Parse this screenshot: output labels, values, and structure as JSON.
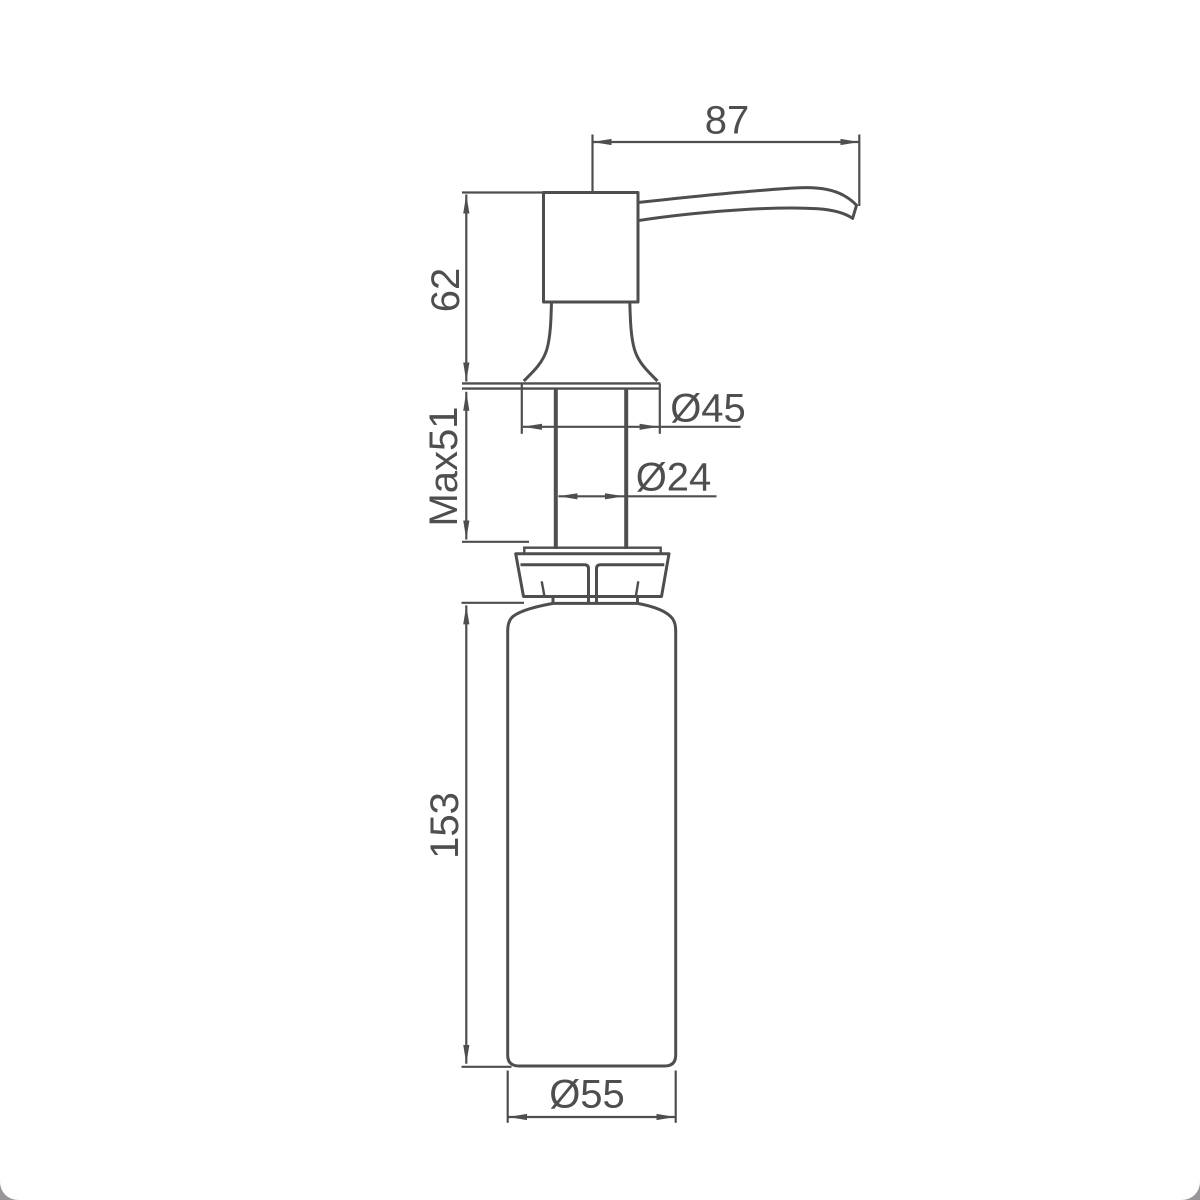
{
  "page": {
    "background": "#ffffff",
    "corner_mask_color": "#98959b"
  },
  "drawing": {
    "type": "technical-drawing",
    "subject": "soap-dispenser-side-elevation",
    "units": "mm",
    "line_color": "#4e4e4e",
    "dimensions": {
      "spout_reach": {
        "label": "87",
        "value": 87
      },
      "head_height": {
        "label": "62",
        "value": 62
      },
      "deck_thickness": {
        "label": "Max51",
        "value": 51
      },
      "flange_diameter": {
        "label": "Ø45",
        "value": 45
      },
      "shank_diameter": {
        "label": "Ø24",
        "value": 24
      },
      "bottle_height": {
        "label": "153",
        "value": 153
      },
      "bottle_diameter": {
        "label": "Ø55",
        "value": 55
      }
    }
  }
}
